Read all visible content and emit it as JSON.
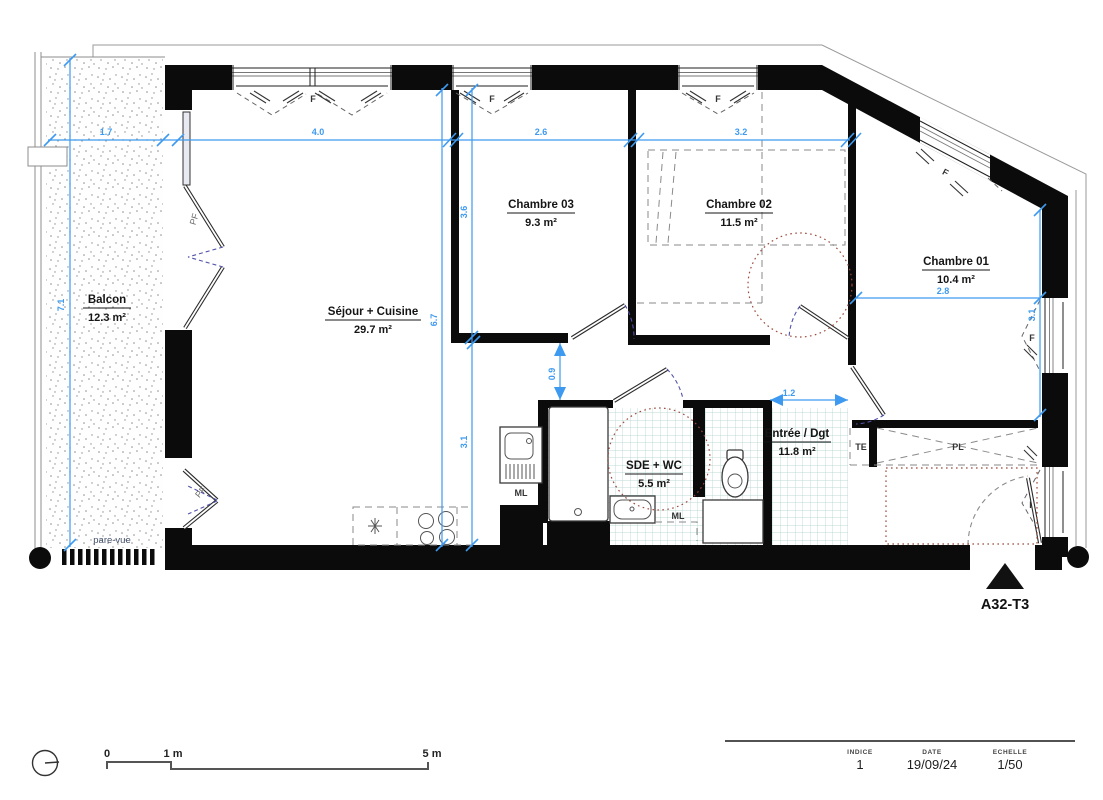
{
  "plan": {
    "id": "A32-T3",
    "rooms": [
      {
        "name": "Balcon",
        "area": "12.3 m²"
      },
      {
        "name": "Séjour + Cuisine",
        "area": "29.7 m²"
      },
      {
        "name": "Chambre 03",
        "area": "9.3 m²"
      },
      {
        "name": "Chambre 02",
        "area": "11.5 m²"
      },
      {
        "name": "Chambre 01",
        "area": "10.4 m²"
      },
      {
        "name": "SDE + WC",
        "area": "5.5 m²"
      },
      {
        "name": "Entrée / Dgt",
        "area": "11.8 m²"
      }
    ],
    "annotations": {
      "window": "F",
      "french_door": "PF",
      "washing_machine": "ML",
      "electrical_panel": "TE",
      "closet": "PL",
      "privacy_screen": "pare-vue"
    },
    "dimensions": {
      "balcony_width": "1.7",
      "sejour_width": "4.0",
      "chambre03_width": "2.6",
      "chambre02_width": "3.2",
      "balcony_height": "7.1",
      "sejour_height": "6.7",
      "chambre03_height": "3.6",
      "sejour_south_height": "3.1",
      "hall_width": "0.9",
      "entry_width": "1.2",
      "chambre01_width": "2.8",
      "chambre01_height": "3.1"
    }
  },
  "scale_bar": {
    "zero": "0",
    "one": "1 m",
    "five": "5 m"
  },
  "title_block": {
    "indice_label": "INDICE",
    "indice_value": "1",
    "date_label": "DATE",
    "date_value": "19/09/24",
    "scale_label": "ECHELLE",
    "scale_value": "1/50"
  },
  "colors": {
    "wall": "#0b0b0b",
    "dimension": "#3d9af0",
    "tile_line": "#bcd9d5",
    "turning_circle": "#9c4a3c",
    "door_swing": "#5252aa"
  }
}
